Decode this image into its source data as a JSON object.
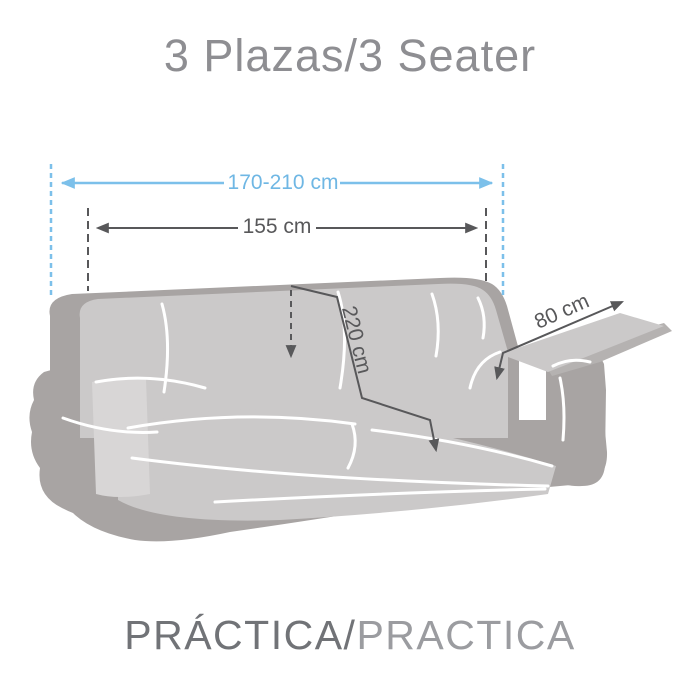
{
  "title": "3 Plazas/3 Seater",
  "measurements": {
    "total_width": "170-210 cm",
    "cover_width": "155 cm",
    "cover_length": "220 cm",
    "arm_flap": "80 cm"
  },
  "footer": {
    "spanish": "PRÁCTICA/",
    "english": "PRACTICA"
  },
  "colors": {
    "accent_blue": "#7cc0ea",
    "dimension_gray": "#58585a",
    "sofa_dark": "#a8a4a3",
    "cover_light": "#cbc9c9",
    "title_gray": "#8e8e92"
  }
}
